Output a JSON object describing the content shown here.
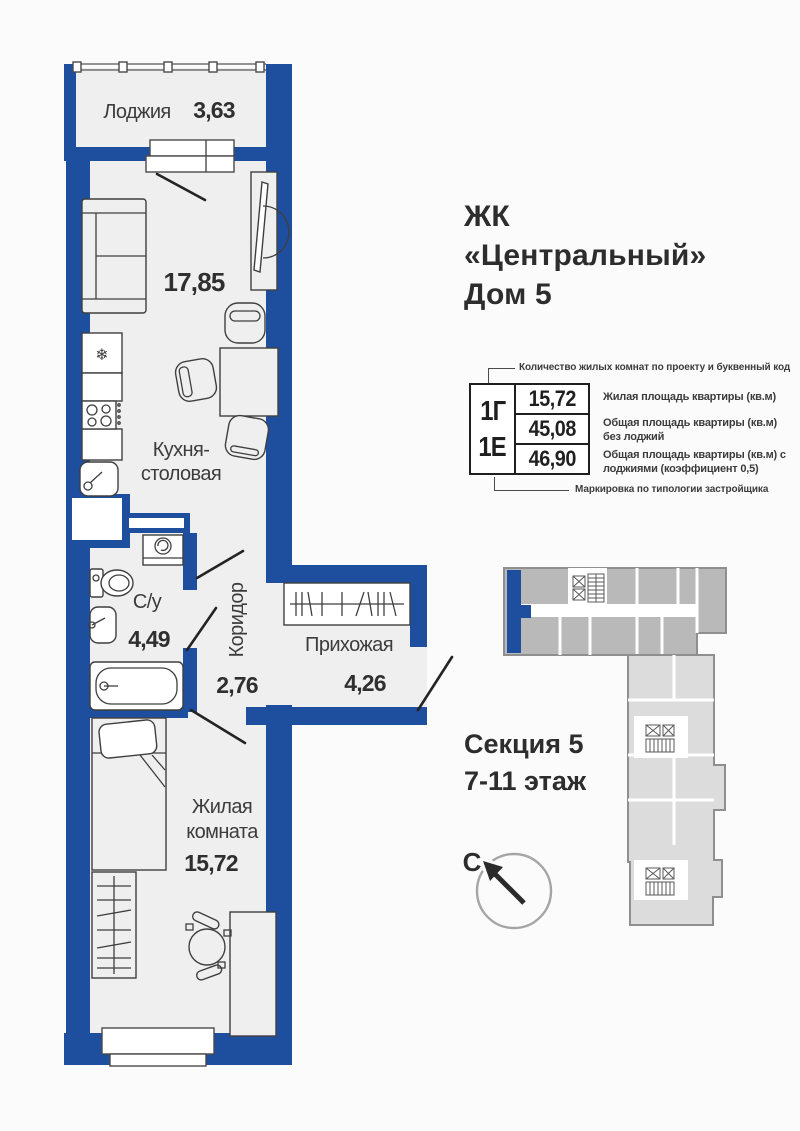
{
  "title": {
    "line1": "ЖК",
    "line2": "«Центральный»",
    "line3": "Дом 5"
  },
  "plan": {
    "loggia": {
      "name": "Лоджия",
      "area": "3,63"
    },
    "kitchen": {
      "name_line1": "Кухня-",
      "name_line2": "столовая",
      "area": "17,85"
    },
    "bathroom": {
      "name": "С/у",
      "area": "4,49"
    },
    "corridor": {
      "name": "Коридор",
      "area": "2,76"
    },
    "hallway": {
      "name": "Прихожая",
      "area": "4,26"
    },
    "living_room": {
      "name_line1": "Жилая",
      "name_line2": "комната",
      "area": "15,72"
    }
  },
  "legend": {
    "top_note": "Количество жилых комнат по проекту и буквенный код",
    "codes": {
      "primary": "1Г",
      "secondary": "1Е"
    },
    "rows": [
      {
        "value": "15,72",
        "desc": "Жилая площадь квартиры (кв.м)"
      },
      {
        "value": "45,08",
        "desc": "Общая площадь квартиры (кв.м) без лоджий"
      },
      {
        "value": "46,90",
        "desc": "Общая площадь квартиры (кв.м) с лоджиями (коэффициент 0,5)"
      }
    ],
    "bottom_note": "Маркировка по типологии застройщика"
  },
  "section_info": {
    "line1": "Секция 5",
    "line2": "7-11 этаж"
  },
  "compass": {
    "north_label": "С"
  },
  "icons": {
    "fridge_snowflake": "❄"
  },
  "colors": {
    "wall": "#1e4f9e",
    "floor": "#efefef",
    "building_dark": "#b9b9b9",
    "building_light": "#dcdcdc",
    "text": "#2d2d2d"
  }
}
